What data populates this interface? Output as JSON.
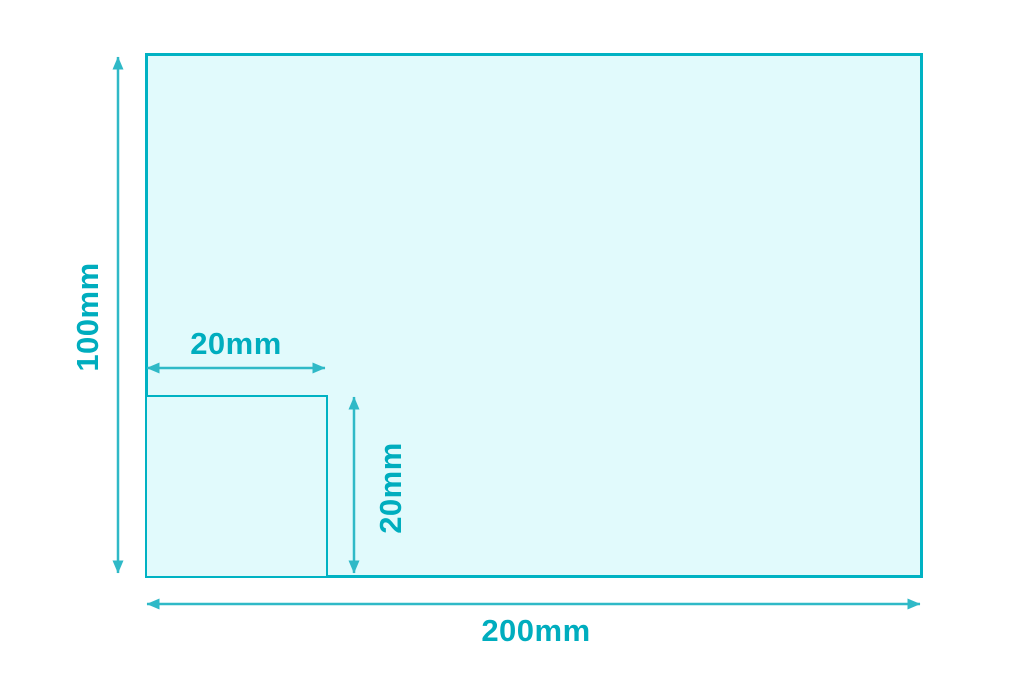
{
  "diagram": {
    "type": "dimensioned-rectangle",
    "outer_rectangle": {
      "width_label": "200mm",
      "height_label": "100mm"
    },
    "inner_square": {
      "width_label": "20mm",
      "height_label": "20mm"
    },
    "colors": {
      "shape_fill": "#e1fafc",
      "shape_stroke": "#00b2c3",
      "dimension_arrow": "#2fb9c7",
      "label_text": "#00adbe"
    }
  }
}
